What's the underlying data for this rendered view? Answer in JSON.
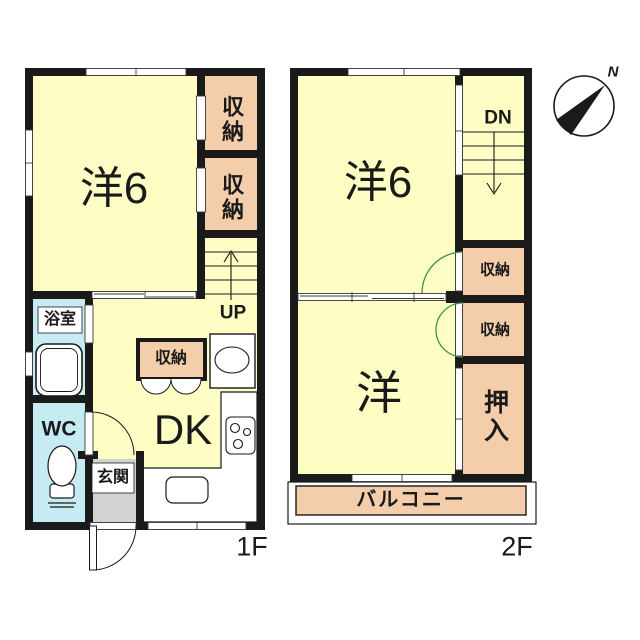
{
  "meta": {
    "type": "japanese-floor-plan"
  },
  "colors": {
    "wall": "#1a1a1a",
    "room_yellow": "#FDFDC4",
    "closet_pink": "#F4CEAA",
    "wet_cyan": "#C6EBF2",
    "entrance_gray": "#D2D2D2",
    "balcony_pink": "#F4CEAA",
    "door_green": "#3F9155"
  },
  "floor1": {
    "floor_label": "1F",
    "western_room": "洋6",
    "storage_a": "収納",
    "storage_b": "収納",
    "stairs_up": "UP",
    "bathroom": "浴室",
    "toilet": "WC",
    "dining_kitchen": "DK",
    "dk_storage": "収納",
    "entrance": "玄関"
  },
  "floor2": {
    "floor_label": "2F",
    "western_room6": "洋6",
    "stairs_down": "DN",
    "storage_a": "収納",
    "storage_b": "収納",
    "western_room": "洋",
    "closet": "押入",
    "balcony": "バルコニー"
  },
  "compass": {
    "north_label": "N"
  }
}
